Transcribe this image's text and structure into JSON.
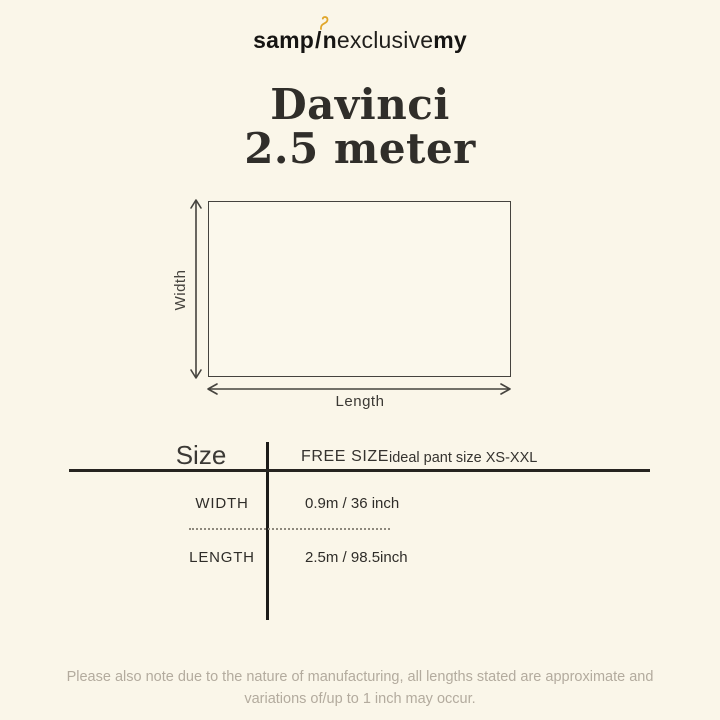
{
  "colors": {
    "background": "#faf6e9",
    "ink": "#34322e",
    "rule": "#262420",
    "gold": "#e0a62a",
    "muted_gray": "#b3ab9e"
  },
  "logo": {
    "part1": "samp",
    "slash": "/",
    "part2": "n",
    "part3": "exclusive",
    "part4": "my",
    "hook_icon": "hanger-hook-icon"
  },
  "title": {
    "line1": "Davinci",
    "line2": "2.5 meter"
  },
  "diagram": {
    "width_label": "Width",
    "length_label": "Length"
  },
  "size_table": {
    "header_label": "Size",
    "free_size_label": "FREE SIZE",
    "ideal_label": "ideal pant size XS-XXL",
    "rows": [
      {
        "label": "WIDTH",
        "value": "0.9m / 36 inch"
      },
      {
        "label": "LENGTH",
        "value": "2.5m / 98.5inch"
      }
    ]
  },
  "disclaimer": {
    "line1": "Please also note due to the nature of manufacturing, all lengths stated are approximate and",
    "line2": "variations of/up to 1 inch may occur."
  }
}
